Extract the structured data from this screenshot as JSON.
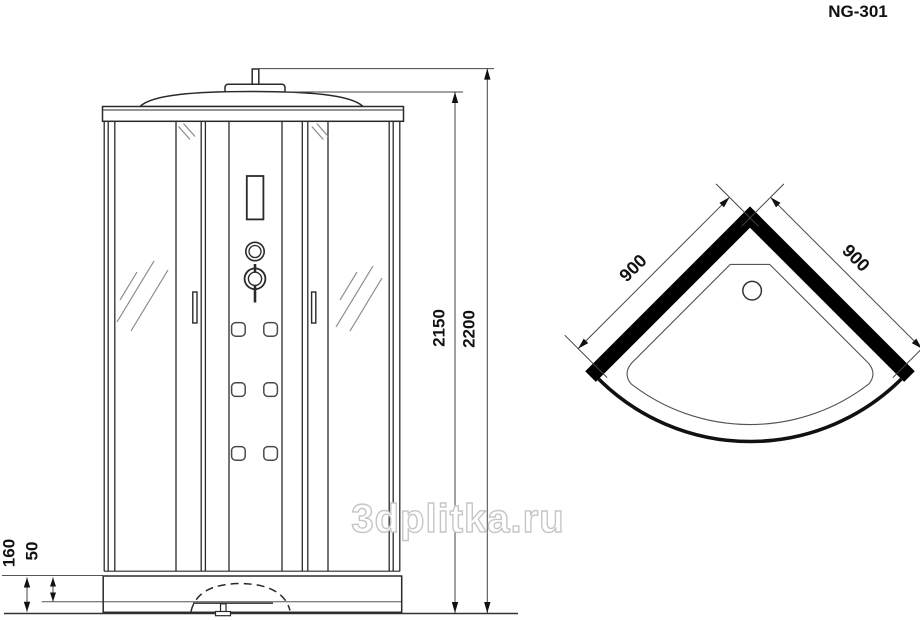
{
  "model": "NG-301",
  "watermark": "3dplitka.ru",
  "front_view": {
    "dim_cabin_height": "2150",
    "dim_total_height": "2200",
    "dim_base_height": "160",
    "dim_tray_rim": "50"
  },
  "top_view": {
    "dim_left_side": "900",
    "dim_right_side": "900"
  },
  "colors": {
    "line": "#2a2a2a",
    "dim_line": "#444444",
    "wall_fill": "#000000",
    "watermark_outline": "#c6c6c6"
  }
}
